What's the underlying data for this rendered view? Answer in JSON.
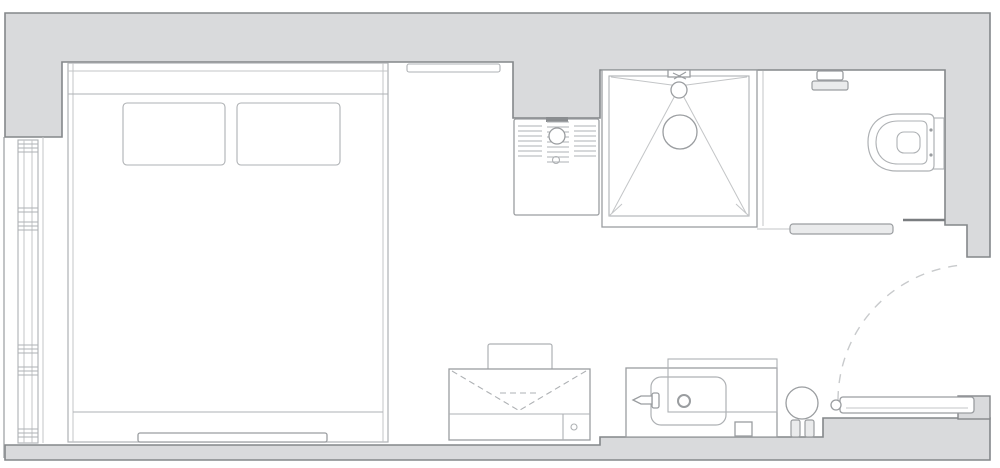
{
  "meta": {
    "type": "floor-plan",
    "aria_label": "studio apartment floor plan"
  },
  "colors": {
    "background": "#ffffff",
    "wall_fill": "#d9dadc",
    "wall_line": "#84878a",
    "dark_line": "#7a7d80",
    "mid_line": "#9a9da0",
    "fixture_line": "#aeb1b4",
    "light_line": "#c3c5c7",
    "dash_line": "#c8cacc",
    "panel_fill": "#eaebec"
  },
  "fixtures": [
    "exterior-walls",
    "window-wall",
    "double-bed",
    "pillow-left",
    "pillow-right",
    "bed-runner-bench",
    "wall-shelf",
    "heater-unit",
    "walk-in-shower",
    "shower-head",
    "toilet",
    "wall-accessory",
    "glass-screen",
    "entry-door",
    "door-swing-arc",
    "stool",
    "desk",
    "chair",
    "fold-down-flap",
    "sink-counter",
    "washbasin",
    "faucet",
    "drain",
    "waste-bin"
  ]
}
